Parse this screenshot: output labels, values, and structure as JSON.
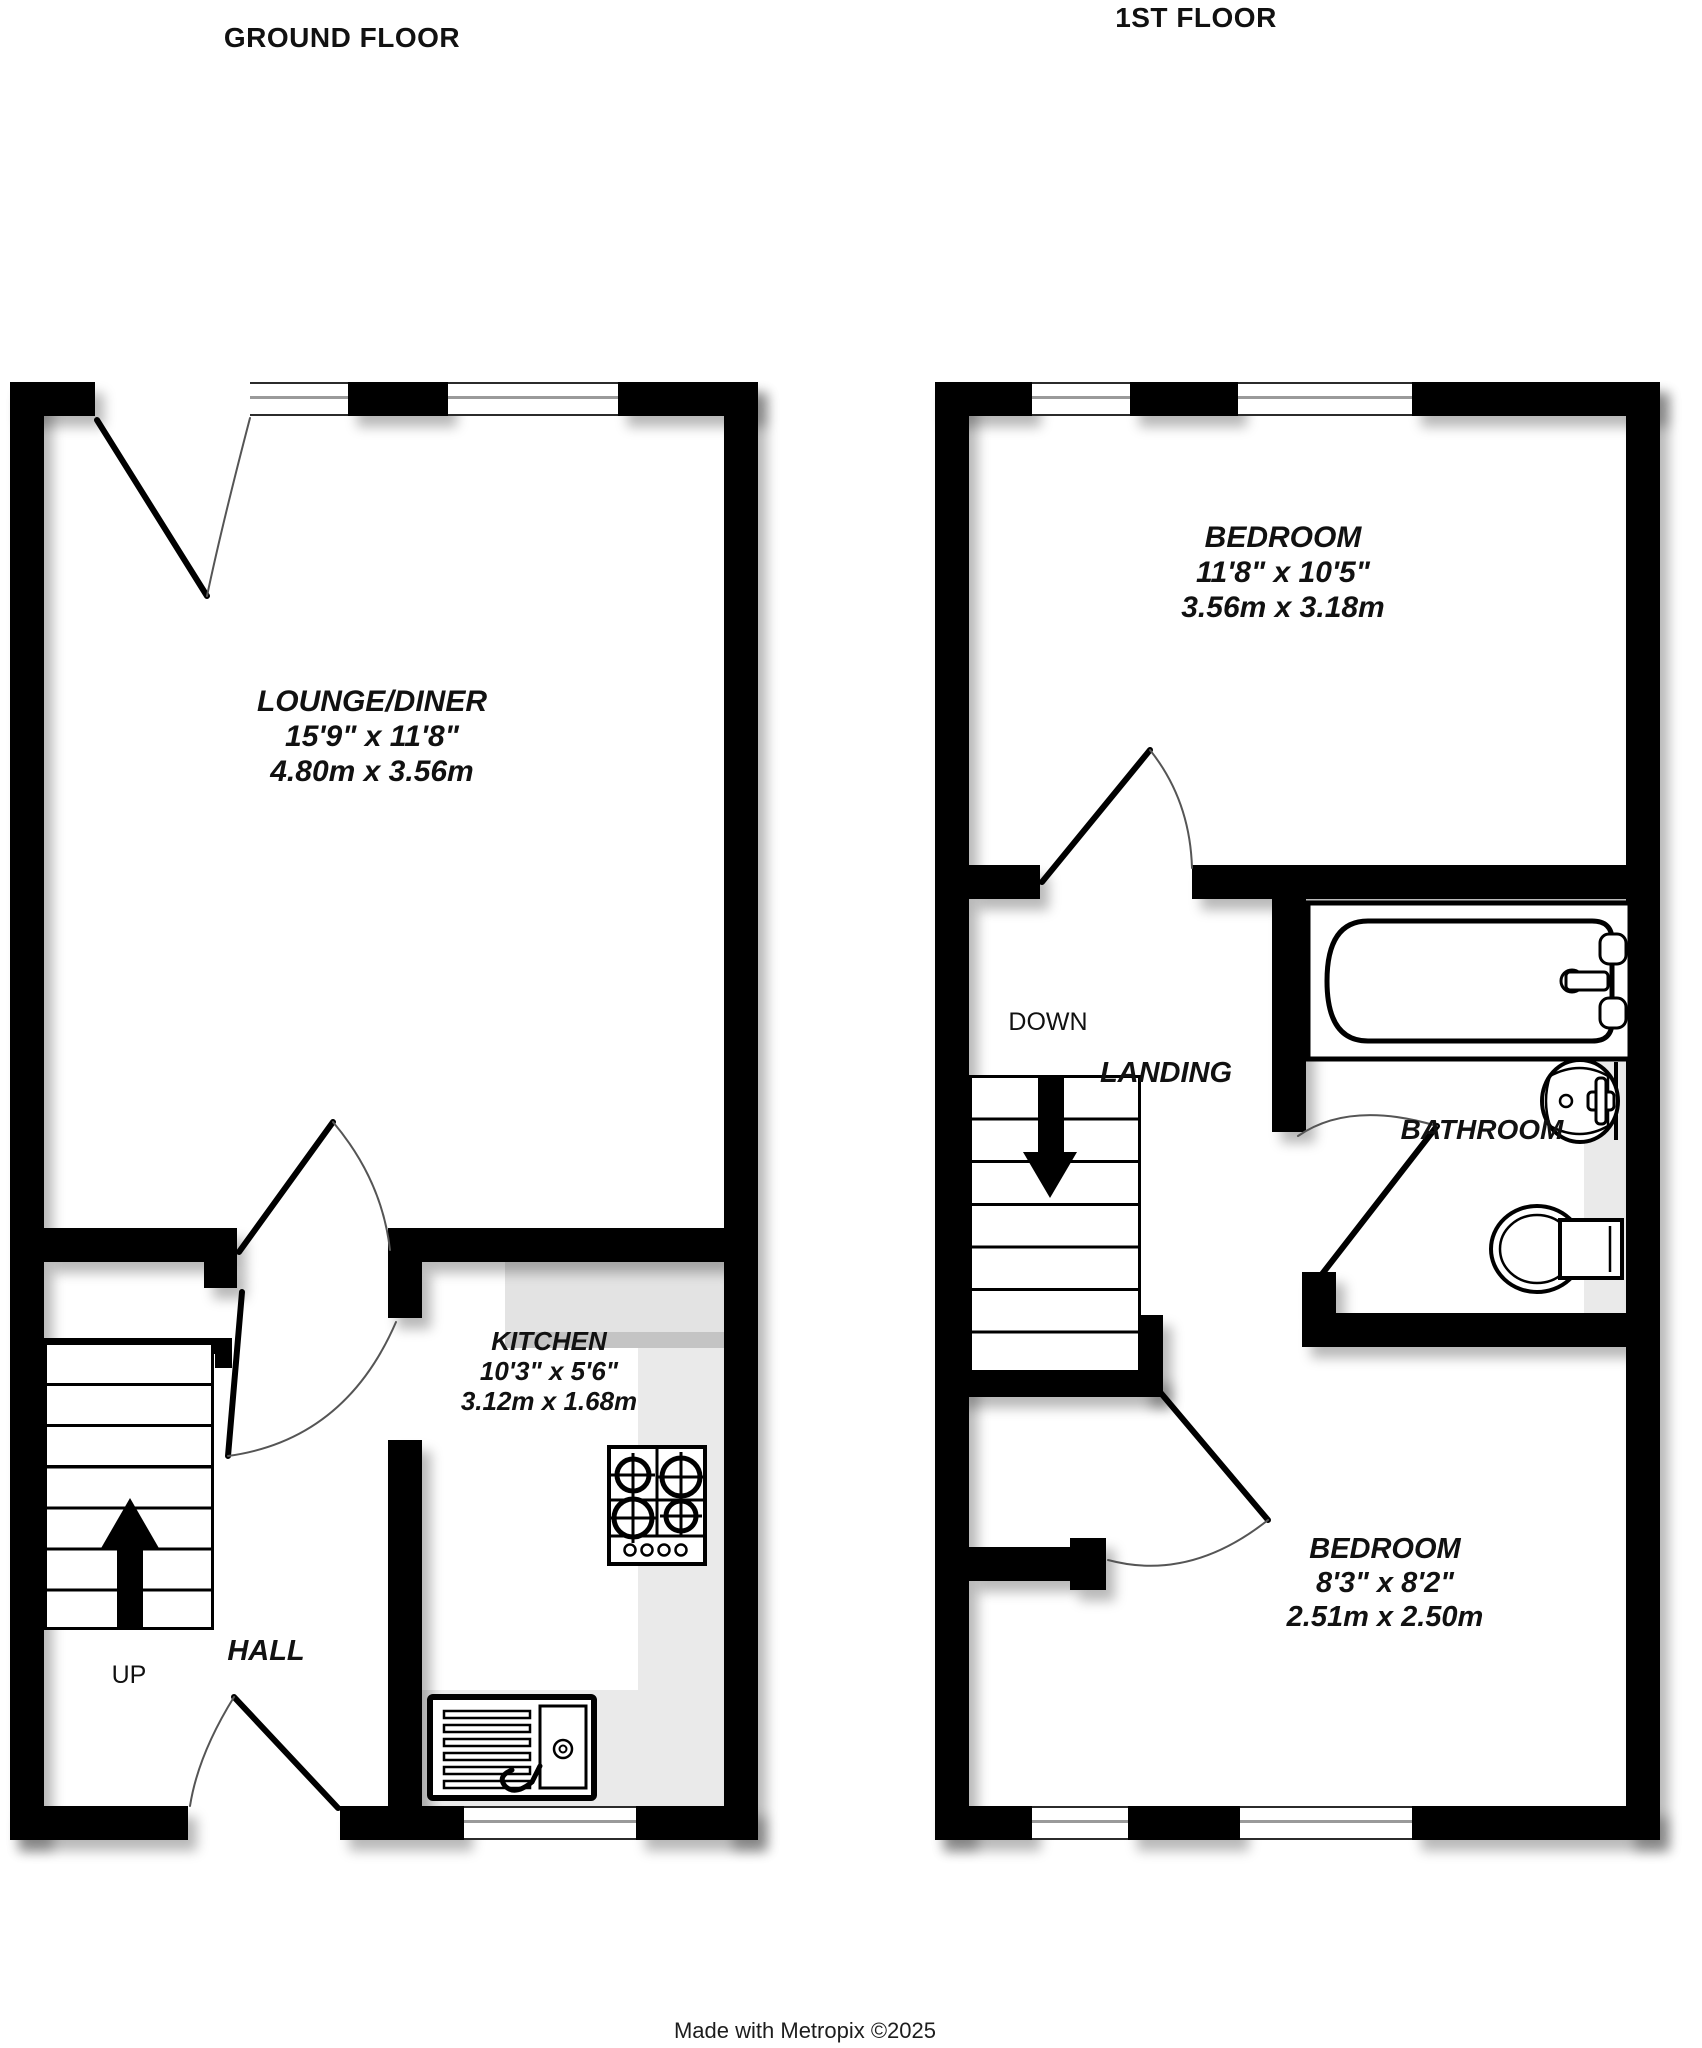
{
  "titles": {
    "ground_floor": "GROUND FLOOR",
    "first_floor": "1ST FLOOR"
  },
  "rooms": {
    "lounge": {
      "name": "LOUNGE/DINER",
      "imperial": "15'9\"  x 11'8\"",
      "metric": "4.80m  x 3.56m"
    },
    "kitchen": {
      "name": "KITCHEN",
      "imperial": "10'3\"  x 5'6\"",
      "metric": "3.12m  x 1.68m"
    },
    "hall": {
      "name": "HALL"
    },
    "bedroom1": {
      "name": "BEDROOM",
      "imperial": "11'8\"  x 10'5\"",
      "metric": "3.56m  x 3.18m"
    },
    "bedroom2": {
      "name": "BEDROOM",
      "imperial": "8'3\"  x 8'2\"",
      "metric": "2.51m  x 2.50m"
    },
    "bathroom": {
      "name": "BATHROOM"
    },
    "landing": {
      "name": "LANDING"
    }
  },
  "stairs": {
    "up_label": "UP",
    "down_label": "DOWN"
  },
  "footer": {
    "credit": "Made with Metropix ©2025"
  },
  "icons": {
    "bathtub": "bathtub-icon",
    "washbasin": "washbasin-icon",
    "toilet": "toilet-icon",
    "hob": "hob-icon",
    "kitchen_sink": "kitchen-sink-icon",
    "up_arrow": "up-arrow-icon",
    "down_arrow": "down-arrow-icon"
  },
  "colors": {
    "wall": "#000000",
    "background": "#ffffff",
    "counter": "#e6e6e6",
    "counter_edge": "#c9c9c9",
    "window_glass": "#9a9a9a",
    "text": "#111111",
    "door_arc": "#555555"
  }
}
